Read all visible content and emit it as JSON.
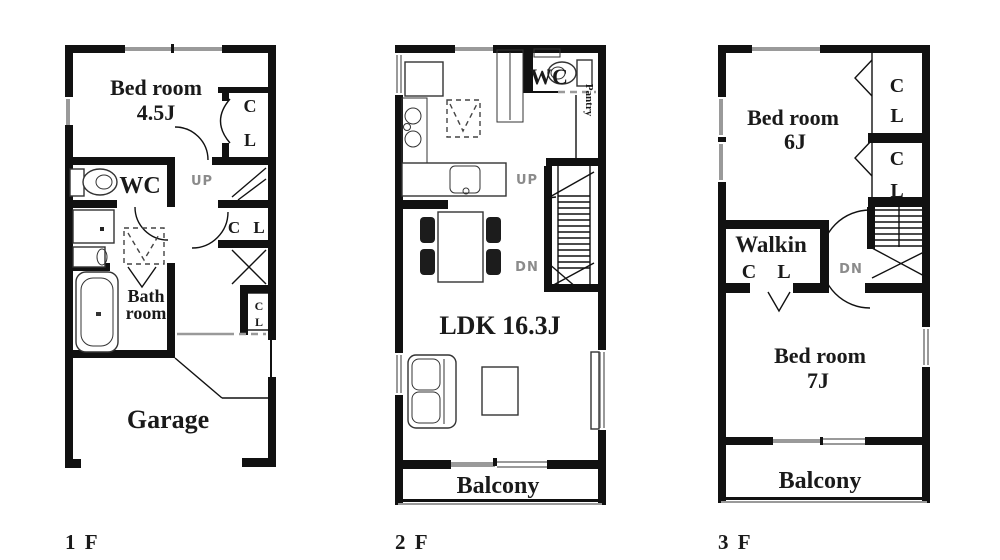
{
  "colors": {
    "background": "#ffffff",
    "wall": "#111111",
    "window": "#9a9a9a",
    "text": "#1a1a1a",
    "stair_label": "#8b8b8b",
    "fixture": "#333333"
  },
  "floors": [
    {
      "name": "1F",
      "label": "1 F",
      "bedroom": {
        "line1": "Bed room",
        "line2": "4.5J"
      },
      "wc": "WC",
      "up": "UP",
      "closet_top": {
        "c": "C",
        "l": "L"
      },
      "closet_mid": {
        "c": "C",
        "l": "L"
      },
      "closet_small": {
        "c": "C",
        "l": "L"
      },
      "bath": {
        "line1": "Bath",
        "line2": "room"
      },
      "garage": "Garage"
    },
    {
      "name": "2F",
      "label": "2 F",
      "wc": "WC",
      "pantry": "Pantry",
      "up": "UP",
      "dn": "DN",
      "ldk": "LDK 16.3J",
      "balcony": "Balcony"
    },
    {
      "name": "3F",
      "label": "3 F",
      "bedroom6": {
        "line1": "Bed room",
        "line2": "6J"
      },
      "closet1": {
        "c": "C",
        "l": "L"
      },
      "closet2": {
        "c": "C",
        "l": "L"
      },
      "walkin": {
        "line1": "Walkin",
        "c": "C",
        "l": "L"
      },
      "dn": "DN",
      "bedroom7": {
        "line1": "Bed room",
        "line2": "7J"
      },
      "balcony": "Balcony"
    }
  ]
}
